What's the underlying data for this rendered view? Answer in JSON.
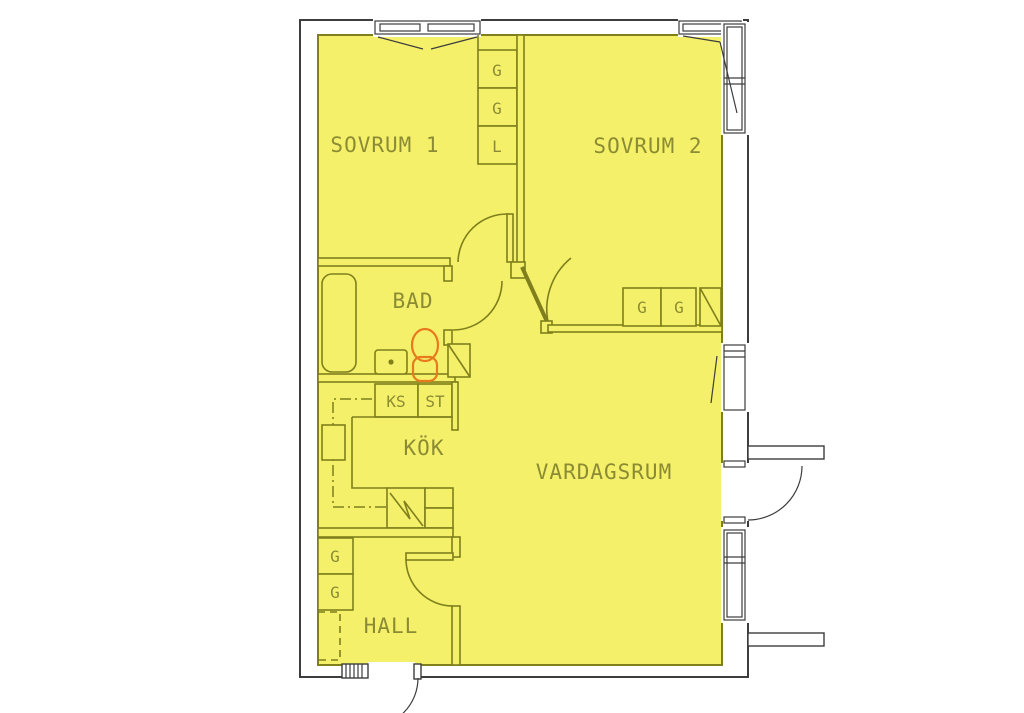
{
  "title": "apartment-floor-plan",
  "rooms": {
    "sovrum1": "SOVRUM 1",
    "sovrum2": "SOVRUM 2",
    "bad": "BAD",
    "kok": "KÖK",
    "vardagsrum": "VARDAGSRUM",
    "hall": "HALL"
  },
  "cabinets": {
    "wardrobe_col_1": "G",
    "wardrobe_col_2": "G",
    "wardrobe_col_3": "L",
    "ks": "KS",
    "st": "ST",
    "sovrum2_g1": "G",
    "sovrum2_g2": "G",
    "hall_g1": "G",
    "hall_g2": "G"
  },
  "colors": {
    "background": "#ffffff",
    "floor": "#f5f06a",
    "line": "#7f7f1c",
    "text": "#8b8b33",
    "wall": "#3d3d3d",
    "toilet": "#e8791d"
  }
}
